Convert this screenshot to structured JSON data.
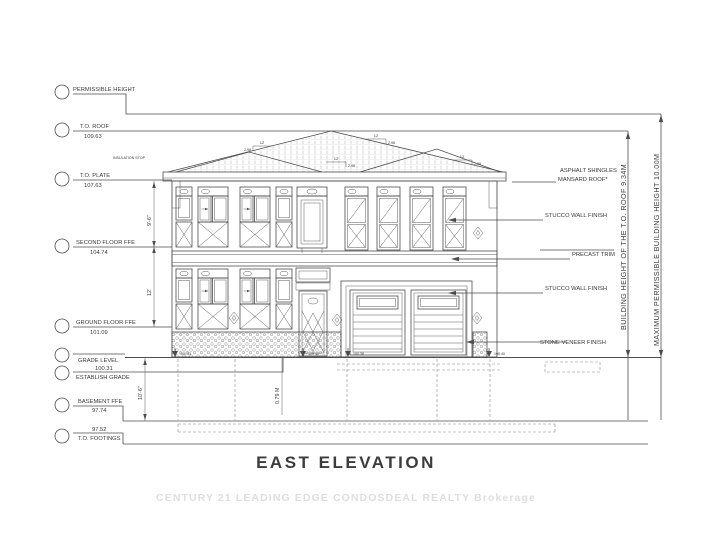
{
  "title": "EAST ELEVATION",
  "watermark": "CENTURY 21 LEADING EDGE CONDOSDEAL REALTY Brokerage",
  "levels": [
    {
      "name": "PERMISSIBLE HEIGHT",
      "value": ""
    },
    {
      "name": "T.O. ROOF",
      "value": "109.63"
    },
    {
      "name": "T.O. PLATE",
      "value": "107.63"
    },
    {
      "name": "SECOND FLOOR FFE",
      "value": "104.74"
    },
    {
      "name": "GROUND FLOOR FFE",
      "value": "101.09"
    },
    {
      "name": "GRADE LEVEL",
      "value": ""
    },
    {
      "name": "ESTABLISH GRADE",
      "value": "100.31"
    },
    {
      "name": "BASEMENT FFE",
      "value": "97.74"
    },
    {
      "name": "T.O. FOOTINGS",
      "value": "97.52"
    }
  ],
  "finishes": {
    "roof_line1": "ASPHALT SHINGLES",
    "roof_line2": "MANSARD ROOF*",
    "stucco_upper": "STUCCO WALL FINISH",
    "precast": "PRECAST TRIM",
    "stucco_lower": "STUCCO WALL FINISH",
    "stone": "STONE VENEER FINISH"
  },
  "height_dims": {
    "building_height": "BUILDING HEIGHT OF THE T.O. ROOF 9.34M",
    "max_permissible": "MAXIMUM PERMISSIBLE BUILDING HEIGHT 10.00M"
  },
  "dims": {
    "plate_to_second": "9'-6\"",
    "second_to_ground": "12'",
    "grade_to_footing": "10'-6\"",
    "sill": "0.79 M"
  },
  "roof_slope": {
    "run": "12",
    "rise": "2.98"
  },
  "notes": {
    "insulation_stop": "INSULATION STOP"
  },
  "spot_elevations": [
    "100.33",
    "100.40",
    "100.38",
    "100.40"
  ],
  "colors": {
    "line": "#4d4d4d",
    "text": "#3a3a3a",
    "watermark": "#dedede",
    "hatch": "#c4c4c4"
  }
}
